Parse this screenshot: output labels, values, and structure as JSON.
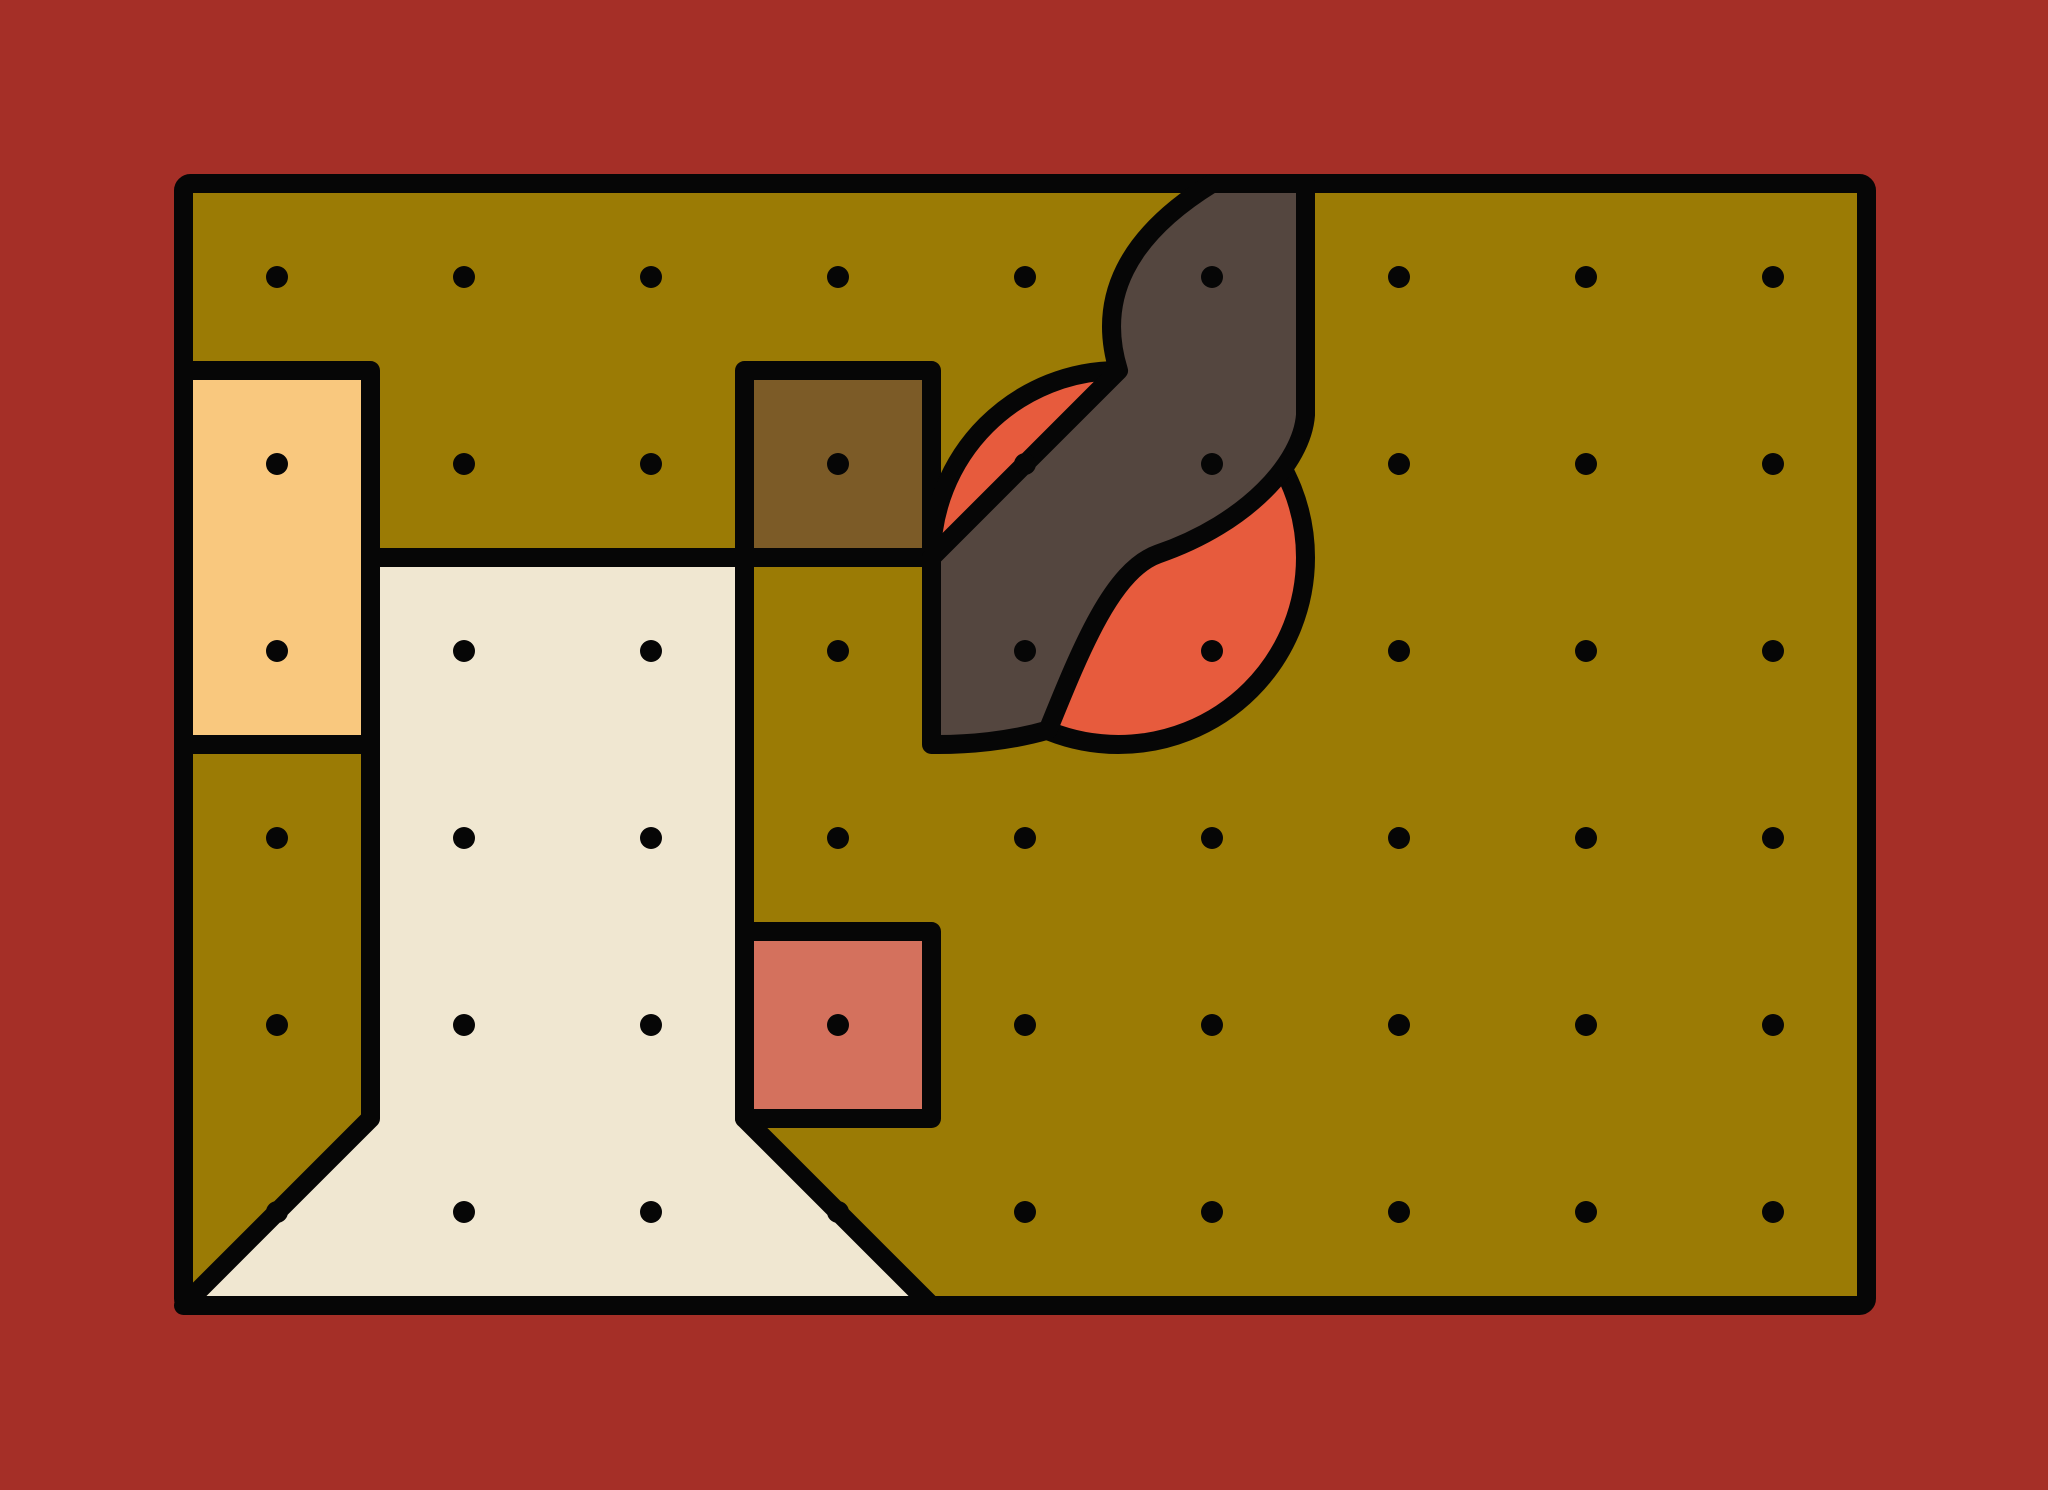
{
  "artwork": {
    "title": "abstract-grid-composition",
    "canvas": {
      "width": 2048,
      "height": 1490
    },
    "palette": {
      "background": "#A52F27",
      "board": "#9B7B05",
      "outline": "#060606",
      "sandy": "#F9C87E",
      "cream": "#F0E7D1",
      "brown": "#7C5B27",
      "salmon": "#D4715D",
      "orange": "#E75B3D",
      "dark": "#54463F"
    },
    "stroke_width": 19,
    "board_corner_radius": 7,
    "grid": {
      "origin_x": 183.5,
      "origin_y": 183.5,
      "cell": 187,
      "cols": 9,
      "rows": 6
    },
    "dots": {
      "radius": 11,
      "fill": "#060606",
      "cols": 9,
      "rows": 6,
      "start_x": 277,
      "start_y": 277,
      "step": 187
    },
    "shapes": [
      {
        "id": "board",
        "name": "board-rectangle",
        "type": "rect",
        "x": 183.5,
        "y": 183.5,
        "w": 1683,
        "h": 1122,
        "rounded": true,
        "fill": "board"
      },
      {
        "id": "sandy",
        "name": "sandy-rectangle",
        "type": "rect",
        "x": 183.5,
        "y": 370.5,
        "w": 187,
        "h": 374,
        "fill": "sandy"
      },
      {
        "id": "cream",
        "name": "cream-funnel-polygon",
        "type": "path",
        "d": "M 370.5 557.5 L 744.5 557.5 L 744.5 1118.5 L 931.5 1305.5 L 183.5 1305.5 L 370.5 1118.5 Z",
        "fill": "cream"
      },
      {
        "id": "brown",
        "name": "brown-square",
        "type": "rect",
        "x": 744.5,
        "y": 370.5,
        "w": 187,
        "h": 187,
        "fill": "brown"
      },
      {
        "id": "salmon",
        "name": "salmon-square",
        "type": "rect",
        "x": 744.5,
        "y": 931.5,
        "w": 187,
        "h": 187,
        "fill": "salmon"
      },
      {
        "id": "circle",
        "name": "orange-circle",
        "type": "circle",
        "cx": 1118.5,
        "cy": 557.5,
        "r": 187,
        "fill": "orange"
      },
      {
        "id": "blob",
        "name": "dark-s-blob",
        "type": "path",
        "d": "M 1212 183.5 L 1305.5 183.5 L 1305.5 415 C 1302 462 1248 523 1158 554 C 1113 570 1082 646 1048 730 C 1010 741 968 745 931.5 744.5 L 931.5 557.5 L 1118.5 370.5 Q 1085 262 1212 183.5 Z",
        "fill": "dark"
      }
    ]
  }
}
